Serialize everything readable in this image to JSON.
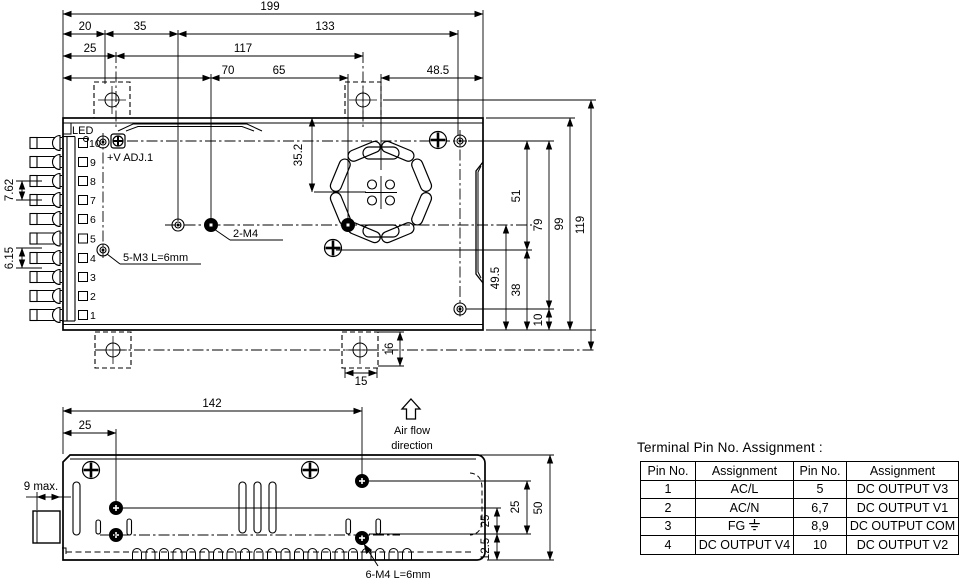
{
  "drawing": {
    "top_view": {
      "led_label": "LED",
      "v_adj_label": "+V ADJ.1",
      "m4_label": "2-M4",
      "m3_label": "5-M3 L=6mm",
      "pin_numbers": [
        "10",
        "9",
        "8",
        "7",
        "6",
        "5",
        "4",
        "3",
        "2",
        "1"
      ]
    },
    "side_view": {
      "m4_label": "6-M4 L=6mm",
      "airflow_line1": "Air flow",
      "airflow_line2": "direction"
    },
    "dims": {
      "d199": "199",
      "d20": "20",
      "d35": "35",
      "d133": "133",
      "d25": "25",
      "d117": "117",
      "d70": "70",
      "d65": "65",
      "d48_5": "48.5",
      "d35_2": "35.2",
      "d51": "51",
      "d38": "38",
      "d79": "79",
      "d10": "10",
      "d99": "99",
      "d119": "119",
      "d49_5": "49.5",
      "d16": "16",
      "d15": "15",
      "d7_62": "7.62",
      "d6_15": "6.15",
      "d142": "142",
      "d25_side": "25",
      "d9max": "9 max.",
      "d25_r1": "25",
      "d25_r2": "25",
      "d50": "50",
      "d12_5": "12.5"
    }
  },
  "table": {
    "title": "Terminal Pin No.  Assignment :",
    "headers": [
      "Pin No.",
      "Assignment",
      "Pin No.",
      "Assignment"
    ],
    "rows": [
      {
        "c0": "1",
        "c1": "AC/L",
        "c2": "5",
        "c3": "DC OUTPUT V3"
      },
      {
        "c0": "2",
        "c1": "AC/N",
        "c2": "6,7",
        "c3": "DC OUTPUT V1"
      },
      {
        "c0": "3",
        "c1": "FG",
        "c2": "8,9",
        "c3": "DC OUTPUT COM"
      },
      {
        "c0": "4",
        "c1": "DC OUTPUT V4",
        "c2": "10",
        "c3": "DC OUTPUT V2"
      }
    ]
  }
}
